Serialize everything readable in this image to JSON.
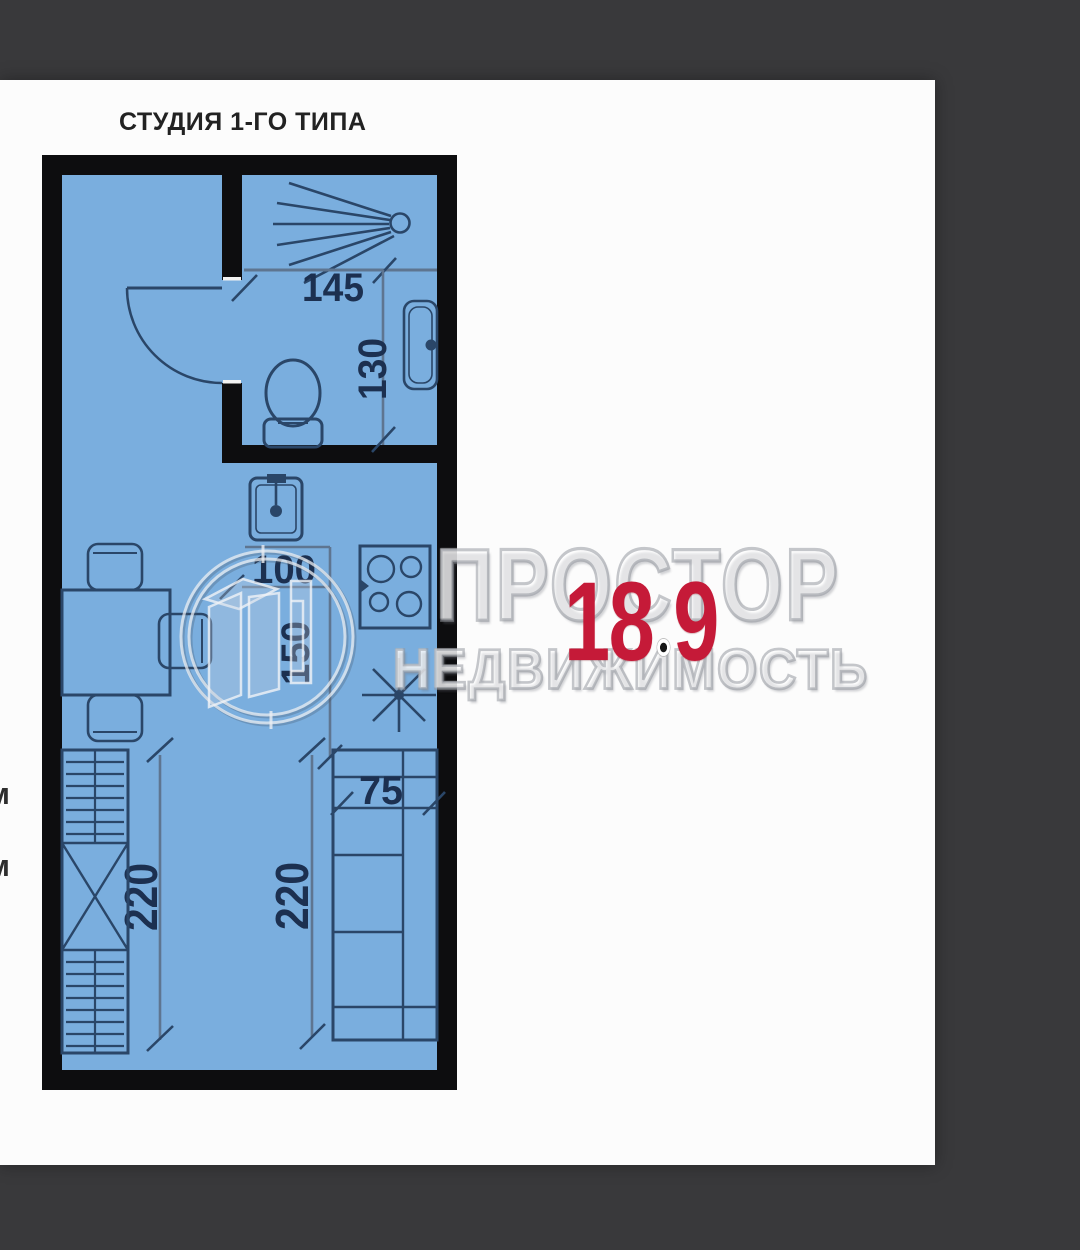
{
  "window": {
    "background_color": "#39393b"
  },
  "paper": {
    "background_color": "#fcfcfc"
  },
  "header": {
    "title": "СТУДИЯ 1-ГО ТИПА"
  },
  "area_label": {
    "int": "18",
    "separator": ".",
    "frac": "9",
    "value": "18.9",
    "color": "#c51a38"
  },
  "watermark": {
    "brand": "ПРОСТОР",
    "tagline": "НЕДВИЖИМОСТЬ",
    "logo": "prostor-circle-door-logo"
  },
  "plan": {
    "floor_color": "#7aaede",
    "wall_color": "#0d0d0f",
    "line_color": "#2a4668",
    "dims": {
      "bath_width": "145",
      "bath_depth": "130",
      "kitchen_width": "100",
      "kitchen_depth": "150",
      "counter_width": "75",
      "left_run": "220",
      "right_run": "220"
    },
    "fixtures": [
      "shower",
      "toilet",
      "bathroom-sink",
      "kitchen-sink",
      "stove",
      "light-star",
      "kitchen-cabinets",
      "wardrobe",
      "dining-table",
      "chairs",
      "door-swing"
    ]
  },
  "edge_labels": {
    "top": "м",
    "bottom": "м"
  }
}
